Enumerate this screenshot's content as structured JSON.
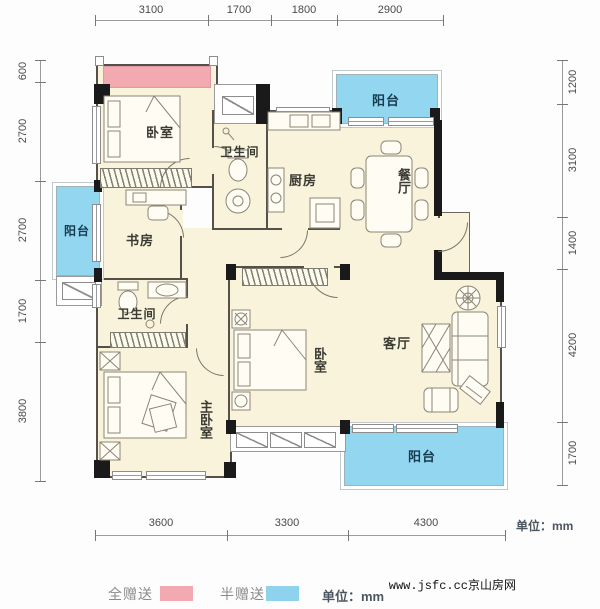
{
  "plan": {
    "rooms": {
      "bedroom1": "卧室",
      "bathroom1": "卫生间",
      "kitchen": "厨房",
      "dining": "餐厅",
      "study": "书房",
      "bathroom2": "卫生间",
      "master_bedroom": "主卧室",
      "bedroom2": "卧室",
      "living": "客厅",
      "balcony_top": "阳台",
      "balcony_left": "阳台",
      "balcony_bottom": "阳台"
    },
    "colors": {
      "room_fill": "#f8f3da",
      "balcony_fill": "#92d6f0",
      "full_gift": "#f2a9b0",
      "half_gift": "#8fd2ee",
      "wall": "#1a1a1a"
    }
  },
  "dimensions": {
    "top": [
      "3100",
      "1700",
      "1800",
      "2900"
    ],
    "left": [
      "600",
      "2700",
      "2700",
      "1700",
      "3800"
    ],
    "right": [
      "1200",
      "3100",
      "1400",
      "4200",
      "1700"
    ],
    "bottom": [
      "3600",
      "3300",
      "4300"
    ],
    "unit": "单位：mm"
  },
  "legend": {
    "full_gift_label": "全赠送",
    "half_gift_label": "半赠送",
    "unit_label": "单位：mm"
  },
  "watermark": "www.jsfc.cc京山房网"
}
